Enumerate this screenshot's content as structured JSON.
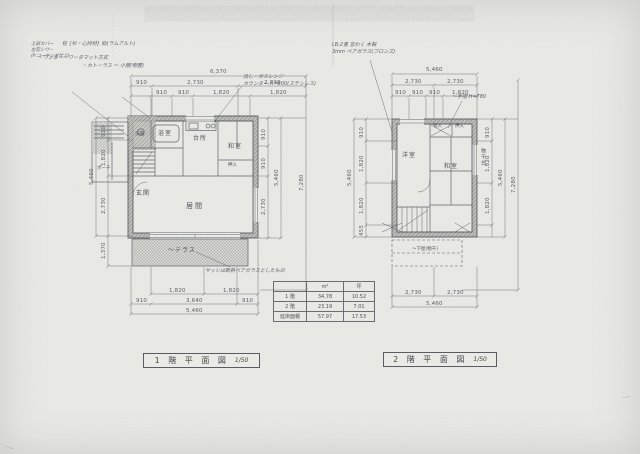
{
  "sheet": {
    "bg": "#eaeae6",
    "ink": "#5a5d64"
  },
  "plan1": {
    "title": "1 階 平 面 図",
    "scale": "1/50",
    "rooms": {
      "bath": "浴室",
      "wash": "洗面",
      "kitchen": "台所",
      "tatami": "和室",
      "closet": "押入",
      "living": "居間",
      "entry": "玄関",
      "porch": "ポーチ",
      "terrace": "〜テラス"
    },
    "dims": {
      "top_overall": "6,370",
      "top_mid": [
        "910",
        "2,730",
        "2,730"
      ],
      "top_inner": [
        "910",
        "910",
        "1,820",
        "1,820"
      ],
      "bottom_pair": [
        "1,820",
        "1,820"
      ],
      "bottom_mid": [
        "910",
        "3,640",
        "910"
      ],
      "bottom_overall": "5,460",
      "left_overall": "5,460",
      "left_segs": [
        "910",
        "1,820",
        "2,730"
      ],
      "left_terrace": "1,370",
      "right_segs": [
        "910",
        "910",
        "2,730"
      ],
      "right_overall": "5,460",
      "right_outer": "7,280"
    },
    "notes": {
      "kitchen": "流し・ガスレンジ\nカウンター H=800(ステンレス)",
      "terrace": "サッシは断熱ペアガラスとしたもの"
    }
  },
  "plan2": {
    "title": "2 階 平 面 図",
    "scale": "1/50",
    "rooms": {
      "west": "洋室",
      "tatami": "和室",
      "closet_a": "物入",
      "closet_b": "押入",
      "lower_roof": "〜下屋(物干)",
      "drying": "物干台"
    },
    "dims": {
      "top_overall": "5,460",
      "top_mid": [
        "2,730",
        "2,730"
      ],
      "top_inner": [
        "910",
        "910",
        "910",
        "1,820"
      ],
      "bottom_mid": [
        "2,730",
        "2,730"
      ],
      "bottom_overall": "5,460",
      "left_overall": "5,460",
      "left_segs": [
        "910",
        "1,820",
        "1,820",
        "455"
      ],
      "right_segs": [
        "910",
        "1,820",
        "1,820"
      ],
      "right_overall": "5,460",
      "right_outer": "7,280"
    },
    "notes": {
      "window": "LB:2重 窓わく 木製\n3mm ペアガラス(ブロンズ)",
      "handrail": "〜手摺 H=780"
    }
  },
  "notes_top_left": {
    "block": "上部カバー\n左官シワ—\n(P.コーキング仕上)",
    "posts": "柱 {杉・心持材} 貼(ラムアルト)",
    "method": "・ワンター・ワータマット方式",
    "shed": "・カトーラス 〜 小屋(物置)"
  },
  "area_table": {
    "headers": [
      "",
      "m²",
      "坪"
    ],
    "rows": [
      [
        "1 階",
        "34.78",
        "10.52"
      ],
      [
        "2 階",
        "23.19",
        "7.01"
      ],
      [
        "延床面積",
        "57.97",
        "17.53"
      ]
    ]
  }
}
